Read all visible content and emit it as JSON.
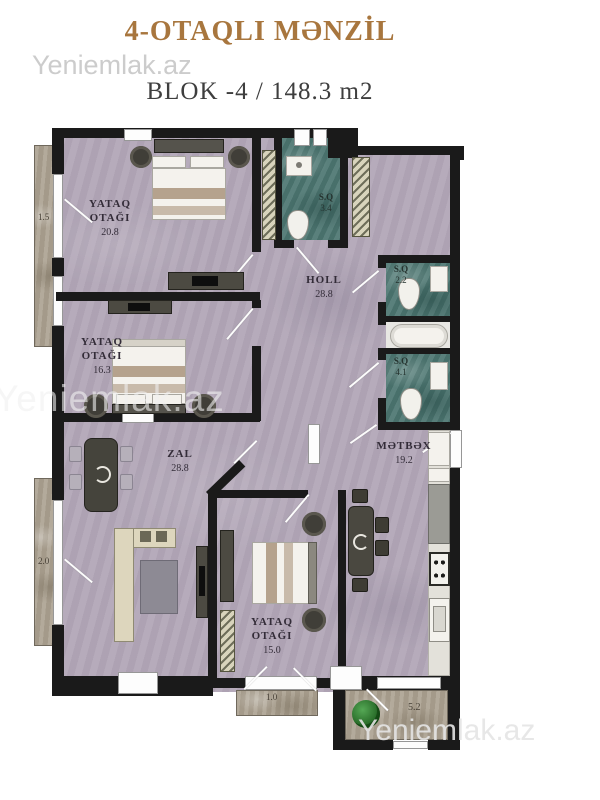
{
  "header": {
    "title": "4-OTAQLI MƏNZİL",
    "subtitle": "BLOK -4 / 148.3 m2"
  },
  "watermarks": {
    "top": "Yeniemlak.az",
    "middle": "Yeniemlak.az",
    "bottom": "Yeniemlak.az"
  },
  "rooms": {
    "bedroom1": {
      "name": "YATAQ OTAĞI",
      "area": "20.8"
    },
    "bedroom2": {
      "name": "YATAQ OTAĞI",
      "area": "16.3"
    },
    "bedroom3": {
      "name": "YATAQ OTAĞI",
      "area": "15.0"
    },
    "zal": {
      "name": "ZAL",
      "area": "28.8"
    },
    "holl": {
      "name": "HOLL",
      "area": "28.8"
    },
    "kitchen": {
      "name": "MƏTBƏX",
      "area": "19.2"
    },
    "wc_top": {
      "name": "S.Q",
      "area": "3.4"
    },
    "wc_right_small": {
      "name": "S.Q",
      "area": "2.2"
    },
    "wc_right_large": {
      "name": "S.Q",
      "area": "4.1"
    }
  },
  "balconies": {
    "left_top": "1.5",
    "left_bottom": "2.0",
    "bottom_center": "1.0",
    "bottom_right": "5.2"
  },
  "colors": {
    "title": "#a8763e",
    "wall": "#1a1a1a",
    "floor": "#b3a8b8",
    "wet_floor": "#4e7772",
    "stone": "#ada393",
    "plant": "#2e7d32"
  }
}
